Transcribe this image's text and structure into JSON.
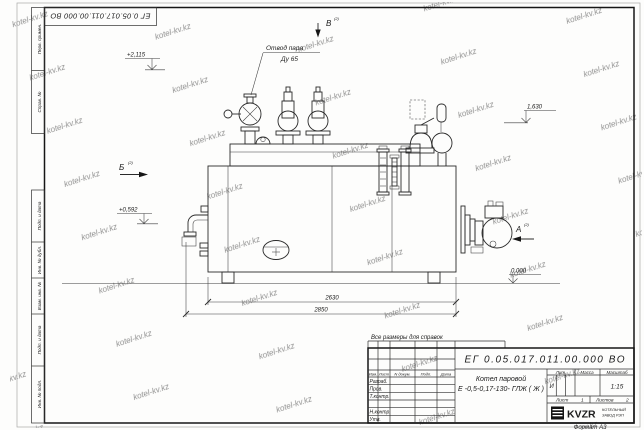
{
  "watermark": {
    "text": "kotel-kv.kz"
  },
  "doc": {
    "designation": "ЕГ 0.05.017.011.00.000  ВО",
    "format_label": "Формат А3",
    "reference_note": "Все размеры для справок"
  },
  "side_stamps": {
    "top": [
      "Перв. примен.",
      "Справ. №"
    ],
    "bottom": [
      "Подп. и дата",
      "Инв. № дубл.",
      "Взам. инв. №",
      "Подп. и дата",
      "Инв. № подл."
    ]
  },
  "drawing": {
    "steam_note": {
      "line1": "Отвод пара",
      "line2": "Ду 65"
    },
    "views": {
      "a": "А",
      "b": "Б",
      "v": "В",
      "ref": "(2)"
    },
    "elevations": {
      "e1": "+2,115",
      "e2": "+0,592",
      "e3": "1,630",
      "e4": "0,000"
    },
    "dimensions": {
      "d1": "2630",
      "d2": "2850"
    }
  },
  "titleblock": {
    "designation": "ЕГ 0.05.017.011.00.000  ВО",
    "name_line1": "Котел паровой",
    "name_line2": "Е -0,5-0,17-130- ГЛЖ ( Ж )",
    "cols": {
      "izm": "Изм.",
      "list": "Лист",
      "ndokum": "N докум.",
      "podp": "Подп.",
      "data": "Дата"
    },
    "rows": [
      "Разраб.",
      "Пров.",
      "Т.контр.",
      "",
      "Н.контр.",
      "Утв."
    ],
    "lit": {
      "label": "Лит.",
      "value": "И"
    },
    "massa": {
      "label": "Масса",
      "value": ""
    },
    "scale": {
      "label": "Масштаб",
      "value": "1:15"
    },
    "sheet": {
      "label": "Лист",
      "value": "1"
    },
    "sheets": {
      "label": "Листов",
      "value": "2"
    },
    "logo": "KVZR",
    "org_line1": "КОТЕЛЬНЫЙ",
    "org_line2": "ЗАВОД РЭП"
  }
}
